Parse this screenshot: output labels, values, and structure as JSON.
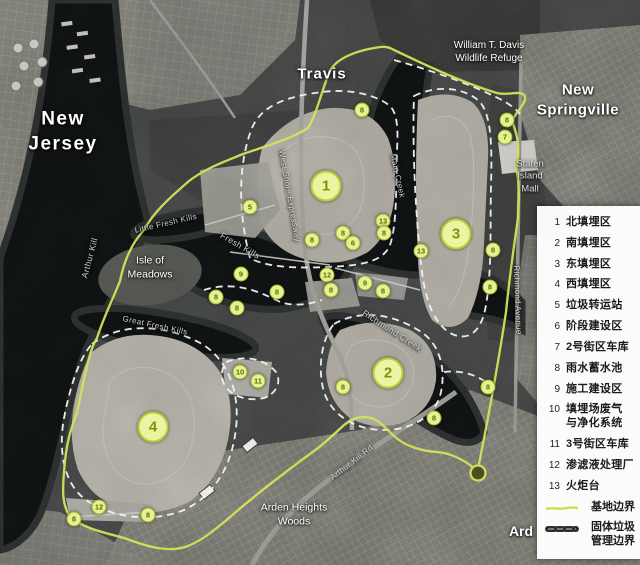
{
  "colors": {
    "site_boundary": "#cbe04b",
    "waste_boundary_dash": "#2e2e2e",
    "marker_fill": "#e6f18f",
    "marker_text": "#5d6b10",
    "legend_background": "#ffffff",
    "legend_text": "#1a1a1a"
  },
  "map": {
    "labels": [
      {
        "name": "label-new-jersey",
        "text": "New\nJersey",
        "x": 63,
        "y": 132,
        "size": 19,
        "bold": true,
        "spacing": 1.5
      },
      {
        "name": "label-travis",
        "text": "Travis",
        "x": 322,
        "y": 74,
        "size": 15,
        "bold": true,
        "spacing": 1
      },
      {
        "name": "label-wildlife-refuge",
        "text": "William T. Davis\nWildlife Refuge",
        "x": 489,
        "y": 52,
        "size": 10,
        "bold": false
      },
      {
        "name": "label-new-springville",
        "text": "New\nSpringville",
        "x": 578,
        "y": 100,
        "size": 15,
        "bold": true,
        "spacing": 0.5
      },
      {
        "name": "label-staten-island-mall",
        "text": "Staten\nIsland\nMall",
        "x": 530,
        "y": 177,
        "size": 9.5,
        "bold": false,
        "color": "#e2e2e0"
      },
      {
        "name": "label-isle-of-meadows",
        "text": "Isle of\nMeadows",
        "x": 150,
        "y": 268,
        "size": 10.5,
        "bold": false
      },
      {
        "name": "label-arden-heights-woods",
        "text": "Arden Heights\nWoods",
        "x": 294,
        "y": 515,
        "size": 10.5,
        "bold": false
      },
      {
        "name": "label-ard",
        "text": "Ard",
        "x": 521,
        "y": 531,
        "size": 14,
        "bold": true
      },
      {
        "name": "label-arthur-kill",
        "text": "Arthur Kill",
        "x": 90,
        "y": 258,
        "size": 8.5,
        "rotate": -75,
        "cls": "water"
      },
      {
        "name": "label-little-fresh-kills",
        "text": "Little Fresh Kills",
        "x": 166,
        "y": 224,
        "size": 8,
        "rotate": -13,
        "cls": "water"
      },
      {
        "name": "label-fresh-kills",
        "text": "Fresh Kills",
        "x": 240,
        "y": 246,
        "size": 8.5,
        "rotate": 30,
        "cls": "water"
      },
      {
        "name": "label-great-fresh-kills",
        "text": "Great Fresh Kills",
        "x": 155,
        "y": 326,
        "size": 8,
        "rotate": 12,
        "cls": "water"
      },
      {
        "name": "label-main-creek",
        "text": "Main Creek",
        "x": 397,
        "y": 176,
        "size": 8,
        "rotate": 78,
        "cls": "water"
      },
      {
        "name": "label-richmond-creek",
        "text": "Richmond Creek",
        "x": 392,
        "y": 331,
        "size": 8.5,
        "rotate": 33,
        "cls": "water"
      },
      {
        "name": "label-richmond-avenue",
        "text": "Richmond Avenue",
        "x": 517,
        "y": 300,
        "size": 8,
        "rotate": 88,
        "cls": "road"
      },
      {
        "name": "label-west-shore-expressway",
        "text": "West Shore Expressway",
        "x": 289,
        "y": 196,
        "size": 8,
        "rotate": 80,
        "cls": "road"
      },
      {
        "name": "label-arthur-kill-road",
        "text": "Arthur Kill Rd",
        "x": 352,
        "y": 463,
        "size": 8,
        "rotate": -38,
        "cls": "road"
      }
    ],
    "markers_large": [
      {
        "num": "1",
        "x": 326,
        "y": 186
      },
      {
        "num": "2",
        "x": 388,
        "y": 373
      },
      {
        "num": "3",
        "x": 456,
        "y": 234
      },
      {
        "num": "4",
        "x": 153,
        "y": 427
      }
    ],
    "markers_small": [
      {
        "num": "5",
        "x": 250,
        "y": 207
      },
      {
        "num": "8",
        "x": 362,
        "y": 110
      },
      {
        "num": "8",
        "x": 507,
        "y": 120
      },
      {
        "num": "7",
        "x": 505,
        "y": 137
      },
      {
        "num": "13",
        "x": 383,
        "y": 221
      },
      {
        "num": "8",
        "x": 384,
        "y": 233
      },
      {
        "num": "8",
        "x": 343,
        "y": 233
      },
      {
        "num": "6",
        "x": 353,
        "y": 243
      },
      {
        "num": "13",
        "x": 421,
        "y": 251
      },
      {
        "num": "8",
        "x": 493,
        "y": 250
      },
      {
        "num": "8",
        "x": 312,
        "y": 240
      },
      {
        "num": "8",
        "x": 490,
        "y": 287
      },
      {
        "num": "9",
        "x": 241,
        "y": 274
      },
      {
        "num": "8",
        "x": 216,
        "y": 297
      },
      {
        "num": "8",
        "x": 277,
        "y": 292
      },
      {
        "num": "8",
        "x": 237,
        "y": 308
      },
      {
        "num": "12",
        "x": 327,
        "y": 275
      },
      {
        "num": "8",
        "x": 331,
        "y": 290
      },
      {
        "num": "9",
        "x": 365,
        "y": 283
      },
      {
        "num": "8",
        "x": 383,
        "y": 291
      },
      {
        "num": "8",
        "x": 343,
        "y": 387
      },
      {
        "num": "8",
        "x": 488,
        "y": 387
      },
      {
        "num": "8",
        "x": 434,
        "y": 418
      },
      {
        "num": "10",
        "x": 240,
        "y": 372
      },
      {
        "num": "11",
        "x": 258,
        "y": 381
      },
      {
        "num": "12",
        "x": 99,
        "y": 507
      },
      {
        "num": "8",
        "x": 74,
        "y": 519
      },
      {
        "num": "8",
        "x": 148,
        "y": 515
      }
    ]
  },
  "legend": {
    "items": [
      {
        "num": "1",
        "label": "北填埋区"
      },
      {
        "num": "2",
        "label": "南填埋区"
      },
      {
        "num": "3",
        "label": "东填埋区"
      },
      {
        "num": "4",
        "label": "西填埋区"
      },
      {
        "num": "5",
        "label": "垃圾转运站"
      },
      {
        "num": "6",
        "label": "阶段建设区"
      },
      {
        "num": "7",
        "label": "2号街区车库"
      },
      {
        "num": "8",
        "label": "雨水蓄水池"
      },
      {
        "num": "9",
        "label": "施工建设区"
      },
      {
        "num": "10",
        "label": "填埋场废气\n与净化系统"
      },
      {
        "num": "11",
        "label": "3号街区车库"
      },
      {
        "num": "12",
        "label": "渗滤液处理厂"
      },
      {
        "num": "13",
        "label": "火炬台"
      }
    ],
    "site_boundary_label": "基地边界",
    "waste_boundary_label": "固体垃圾\n管理边界"
  }
}
